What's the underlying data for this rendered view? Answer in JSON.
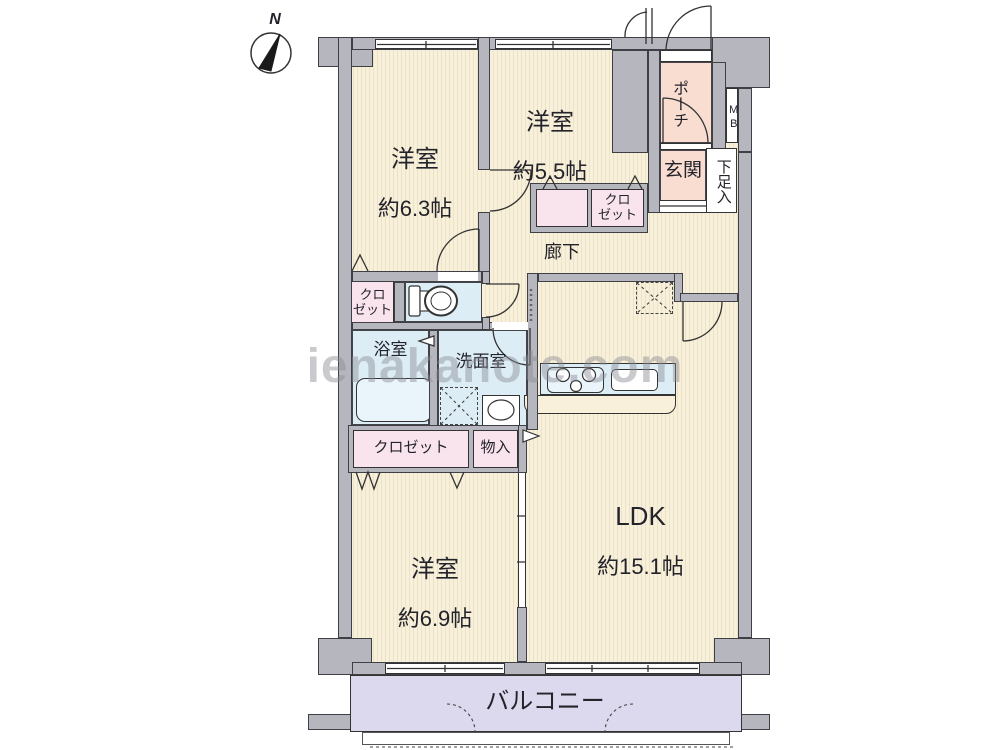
{
  "compass": {
    "north_label": "N"
  },
  "watermark": {
    "text": "ienakanote.com"
  },
  "rooms": {
    "bedroom_nw": {
      "name": "洋室",
      "size": "約6.3帖"
    },
    "bedroom_n": {
      "name": "洋室",
      "size": "約5.5帖"
    },
    "bedroom_sw": {
      "name": "洋室",
      "size": "約6.9帖"
    },
    "ldk": {
      "name": "LDK",
      "size": "約15.1帖"
    },
    "hallway": {
      "name": "廊下"
    },
    "entrance": {
      "name": "玄関"
    },
    "porch": {
      "name": "ポーチ"
    },
    "shoe_cabinet": {
      "name": "下足入"
    },
    "meter_box": {
      "name": "MB"
    },
    "bathroom": {
      "name": "浴室"
    },
    "washroom": {
      "name": "洗面室"
    },
    "closet_north": {
      "name": "クロ\nゼット"
    },
    "closet_west": {
      "name": "クロ\nゼット"
    },
    "closet_south": {
      "name": "クロゼット"
    },
    "storage": {
      "name": "物入"
    },
    "balcony": {
      "name": "バルコニー"
    }
  },
  "colors": {
    "floor_cream": "#f8f0da",
    "floor_stripe": "#ece2c7",
    "closet_pink": "#f9e4ee",
    "water_blue": "#dcedf6",
    "entrance_peach": "#f8ddd0",
    "balcony_lavender": "#dcd8ed",
    "wall_gray": "#b6b6be"
  }
}
